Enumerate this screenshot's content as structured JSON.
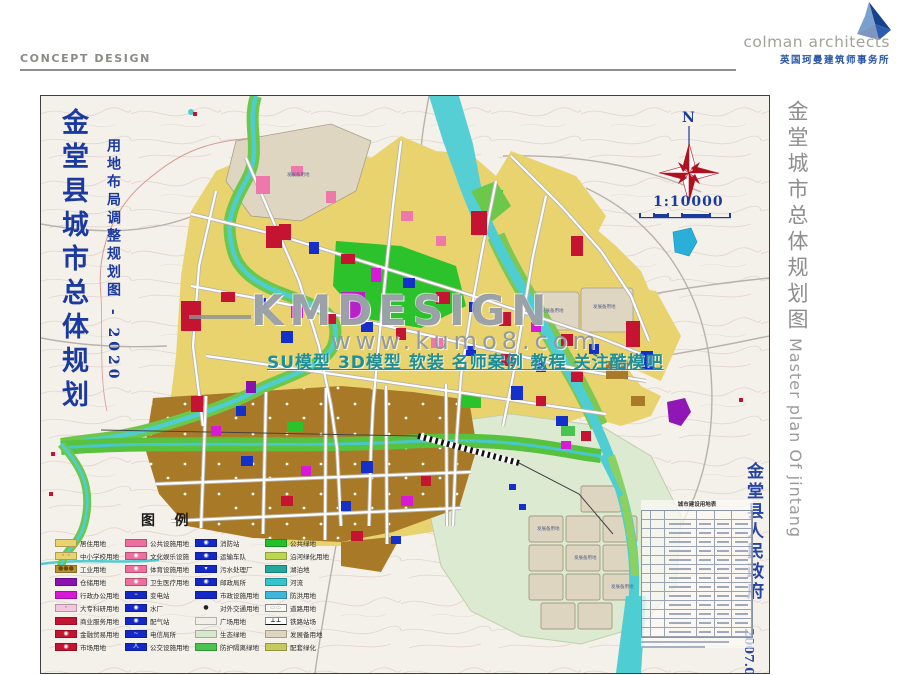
{
  "header": {
    "label": "CONCEPT DESIGN"
  },
  "logo": {
    "name": "colman architects",
    "subtitle": "英国珂曼建筑师事务所",
    "accent": "#16418c"
  },
  "side": {
    "title_cn": "金堂城市总体规划图",
    "title_en": "Master plan Of jintang"
  },
  "map": {
    "title_main": "金堂县城市总体规划",
    "title_sub": "用地布局调整规划图 - 2020",
    "north": "N",
    "scale": "1:10000",
    "stamp_gov": "金堂县人民政府",
    "stamp_date": "2007.07",
    "table_title": "城市建设用地表",
    "reserve_label": "发展备用地"
  },
  "watermark": {
    "line1": "KMDESIGN",
    "line2": "www.kumo8.com",
    "line3": "SU模型 3D模型 软装 名师案例 教程 关注酷模吧"
  },
  "legend": {
    "title": "图    例",
    "columns": [
      [
        {
          "label": "居住用地",
          "color": "#e9d36e"
        },
        {
          "label": "中小学校用地",
          "color": "#e9d36e",
          "sym": "◦ ◦",
          "symColor": "#555"
        },
        {
          "label": "工业用地",
          "color": "#b8922c",
          "sym": "●●●",
          "symColor": "#6a4a10"
        },
        {
          "label": "仓储用地",
          "color": "#8a10b0"
        },
        {
          "label": "行政办公用地",
          "color": "#d81ad8"
        },
        {
          "label": "大专科研用地",
          "color": "#f2c6dc",
          "sym": "◦",
          "symColor": "#555"
        },
        {
          "label": "商业服务用地",
          "color": "#c41432"
        },
        {
          "label": "金融贸易用地",
          "color": "#c41432",
          "sym": "◉",
          "symColor": "#ffffff"
        },
        {
          "label": "市场用地",
          "color": "#c41432",
          "sym": "◉",
          "symColor": "#ffffff"
        }
      ],
      [
        {
          "label": "公共设施用地",
          "color": "#ee6e9e"
        },
        {
          "label": "文化娱乐设施",
          "color": "#ee6e9e",
          "sym": "◉",
          "symColor": "#ffffff"
        },
        {
          "label": "体育设施用地",
          "color": "#ee6e9e",
          "sym": "◉",
          "symColor": "#ffffff"
        },
        {
          "label": "卫生医疗用地",
          "color": "#ee6e9e",
          "sym": "◉",
          "symColor": "#ffffff"
        },
        {
          "label": "变电站",
          "color": "#1428c8",
          "sym": "⌁",
          "symColor": "#ffd24a"
        },
        {
          "label": "水厂",
          "color": "#1428c8",
          "sym": "◉",
          "symColor": "#ffffff"
        },
        {
          "label": "配气站",
          "color": "#1428c8",
          "sym": "◉",
          "symColor": "#ffffff"
        },
        {
          "label": "电信局所",
          "color": "#1428c8",
          "sym": "~",
          "symColor": "#ffffff"
        },
        {
          "label": "公交设施用地",
          "color": "#1428c8",
          "sym": "人",
          "symColor": "#ffffff"
        }
      ],
      [
        {
          "label": "消防站",
          "color": "#1428c8",
          "sym": "◉",
          "symColor": "#ffffff"
        },
        {
          "label": "运输车队",
          "color": "#1428c8",
          "sym": "◉",
          "symColor": "#ffffff"
        },
        {
          "label": "污水处理厂",
          "color": "#1428c8",
          "sym": "▾",
          "symColor": "#ffffff"
        },
        {
          "label": "邮政局所",
          "color": "#1428c8",
          "sym": "◉",
          "symColor": "#ffffff"
        },
        {
          "label": "市政设施用地",
          "color": "#1428c8"
        },
        {
          "label": "对外交通用地",
          "color": "none",
          "sym": "●",
          "symColor": "#222222"
        },
        {
          "label": "广场用地",
          "color": "#f2efe8"
        },
        {
          "label": "生态绿地",
          "color": "#d9e8cc"
        },
        {
          "label": "防护隔离绿地",
          "color": "#49c44e"
        }
      ],
      [
        {
          "label": "公共绿地",
          "color": "#22c02a"
        },
        {
          "label": "沿河绿化用地",
          "color": "#bcd64e"
        },
        {
          "label": "湖泊地",
          "color": "#23a8a0"
        },
        {
          "label": "河流",
          "color": "#2fc6ce"
        },
        {
          "label": "防洪用地",
          "color": "#3fb6dc"
        },
        {
          "label": "道路用地",
          "type": "road"
        },
        {
          "label": "铁路站场",
          "type": "rail"
        },
        {
          "label": "发展备用地",
          "color": "#ddd5bf"
        },
        {
          "label": "配套绿化",
          "color": "#c6ca5a"
        }
      ]
    ]
  }
}
